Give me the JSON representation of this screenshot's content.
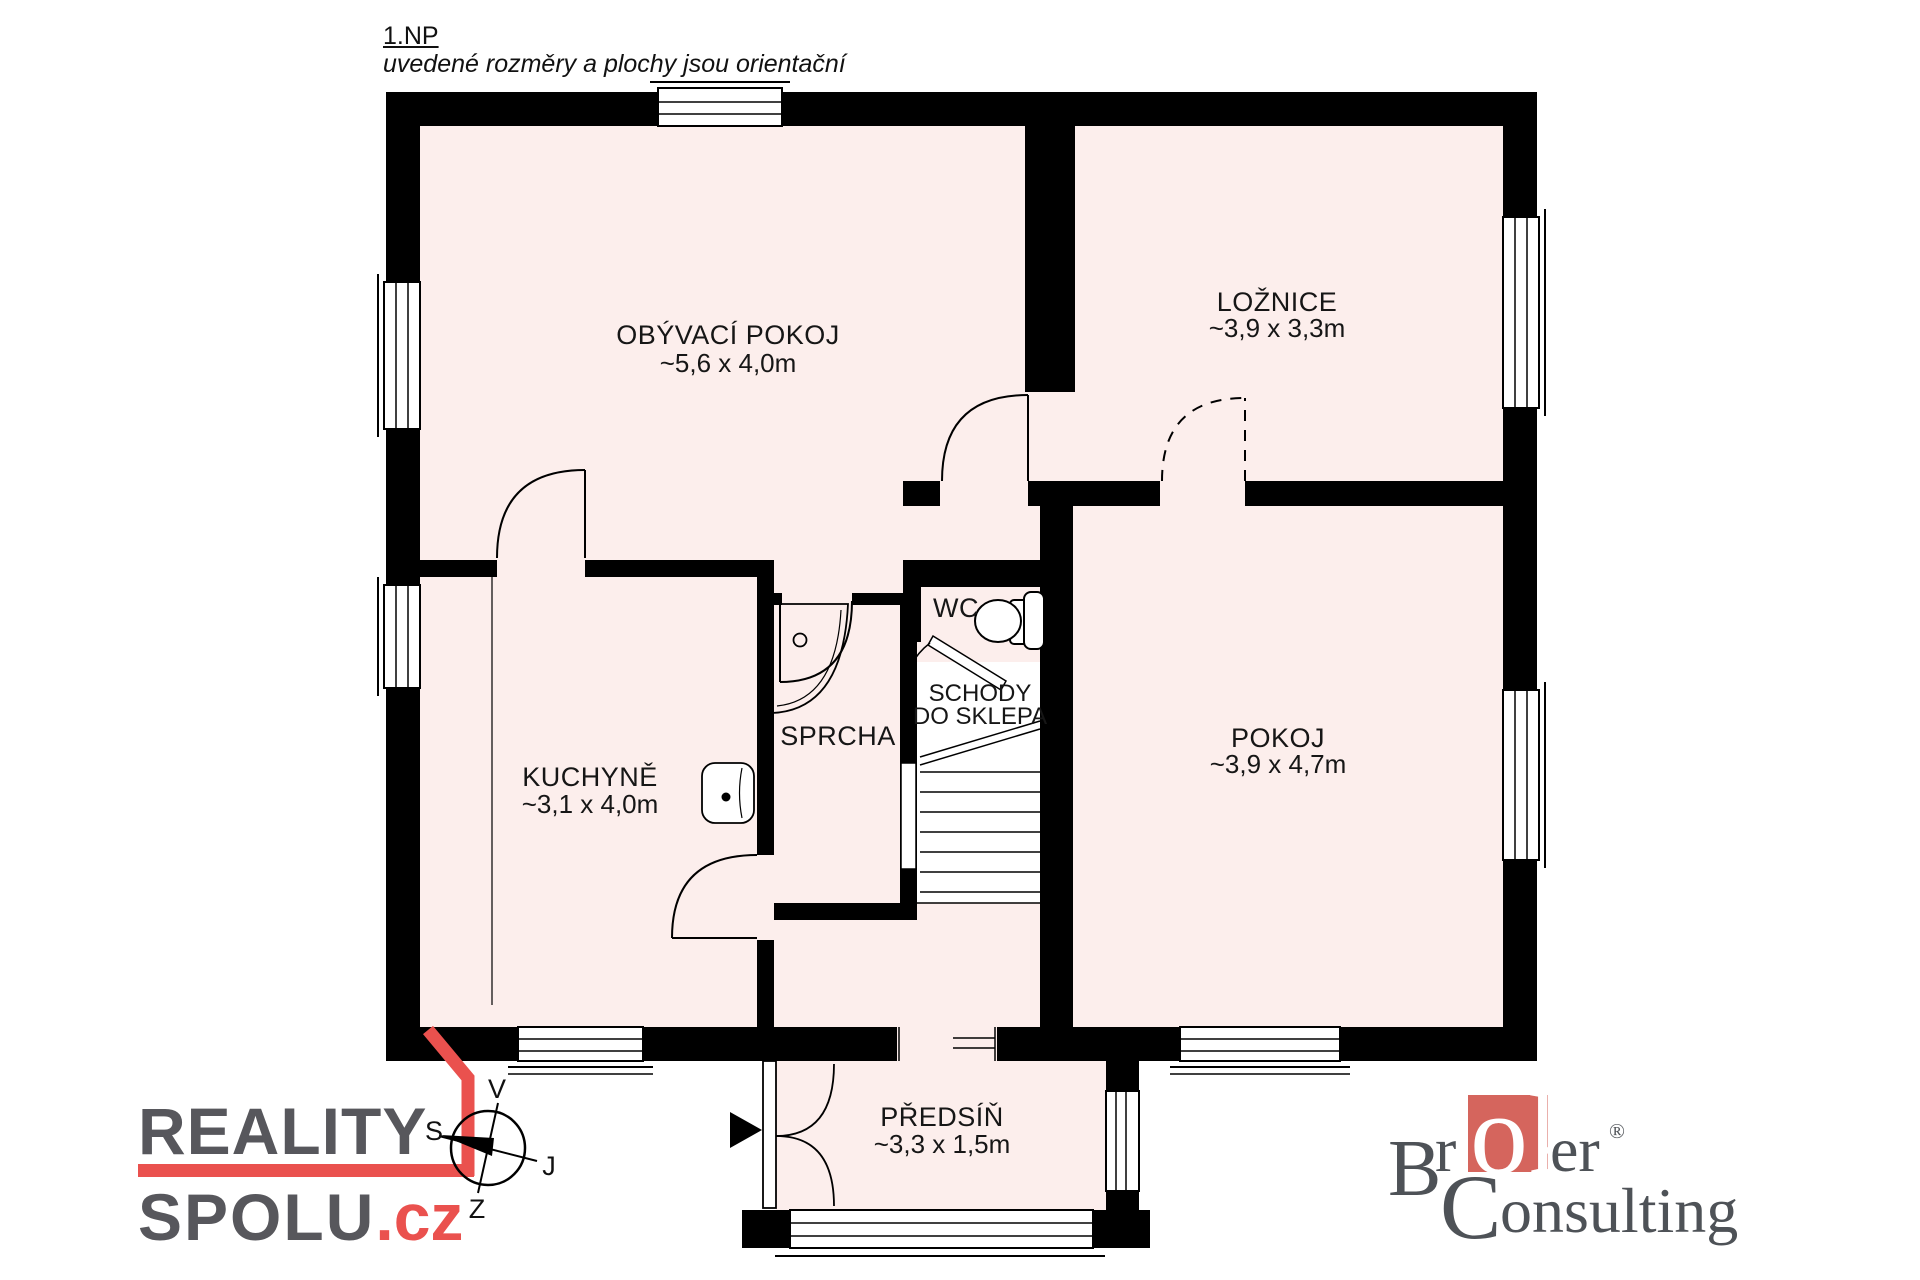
{
  "header": {
    "title": "1.NP",
    "subtitle": "uvedené rozměry a plochy jsou orientační"
  },
  "rooms": {
    "living": {
      "name": "OBÝVACÍ POKOJ",
      "dims": "~5,6 x 4,0m"
    },
    "bedroom": {
      "name": "LOŽNICE",
      "dims": "~3,9 x 3,3m"
    },
    "kitchen": {
      "name": "KUCHYNĚ",
      "dims": "~3,1 x 4,0m"
    },
    "shower": {
      "name": "SPRCHA"
    },
    "wc": {
      "name": "WC"
    },
    "stairs": {
      "line1": "SCHODY",
      "line2": "DO SKLEPA"
    },
    "room": {
      "name": "POKOJ",
      "dims": "~3,9 x 4,7m"
    },
    "hallway": {
      "name": "PŘEDSÍŇ",
      "dims": "~3,3 x 1,5m"
    }
  },
  "compass": {
    "east": "V",
    "south": "J",
    "west": "Z",
    "north": "S"
  },
  "logo_left": {
    "line1": "REALITY",
    "line2": "SPOLU",
    "tld": ".cz",
    "accent_color": "#ea514e",
    "text_color": "#57575c"
  },
  "logo_right": {
    "b": "B",
    "r1": "r",
    "ok": "ok",
    "er": "er",
    "reg": "®",
    "c": "C",
    "onsulting": "onsulting",
    "square_color": "#d5655d",
    "text_color": "#4e5257"
  },
  "colors": {
    "wall": "#000000",
    "room_fill": "#fceeec",
    "stairwell_fill": "#ffffff"
  }
}
